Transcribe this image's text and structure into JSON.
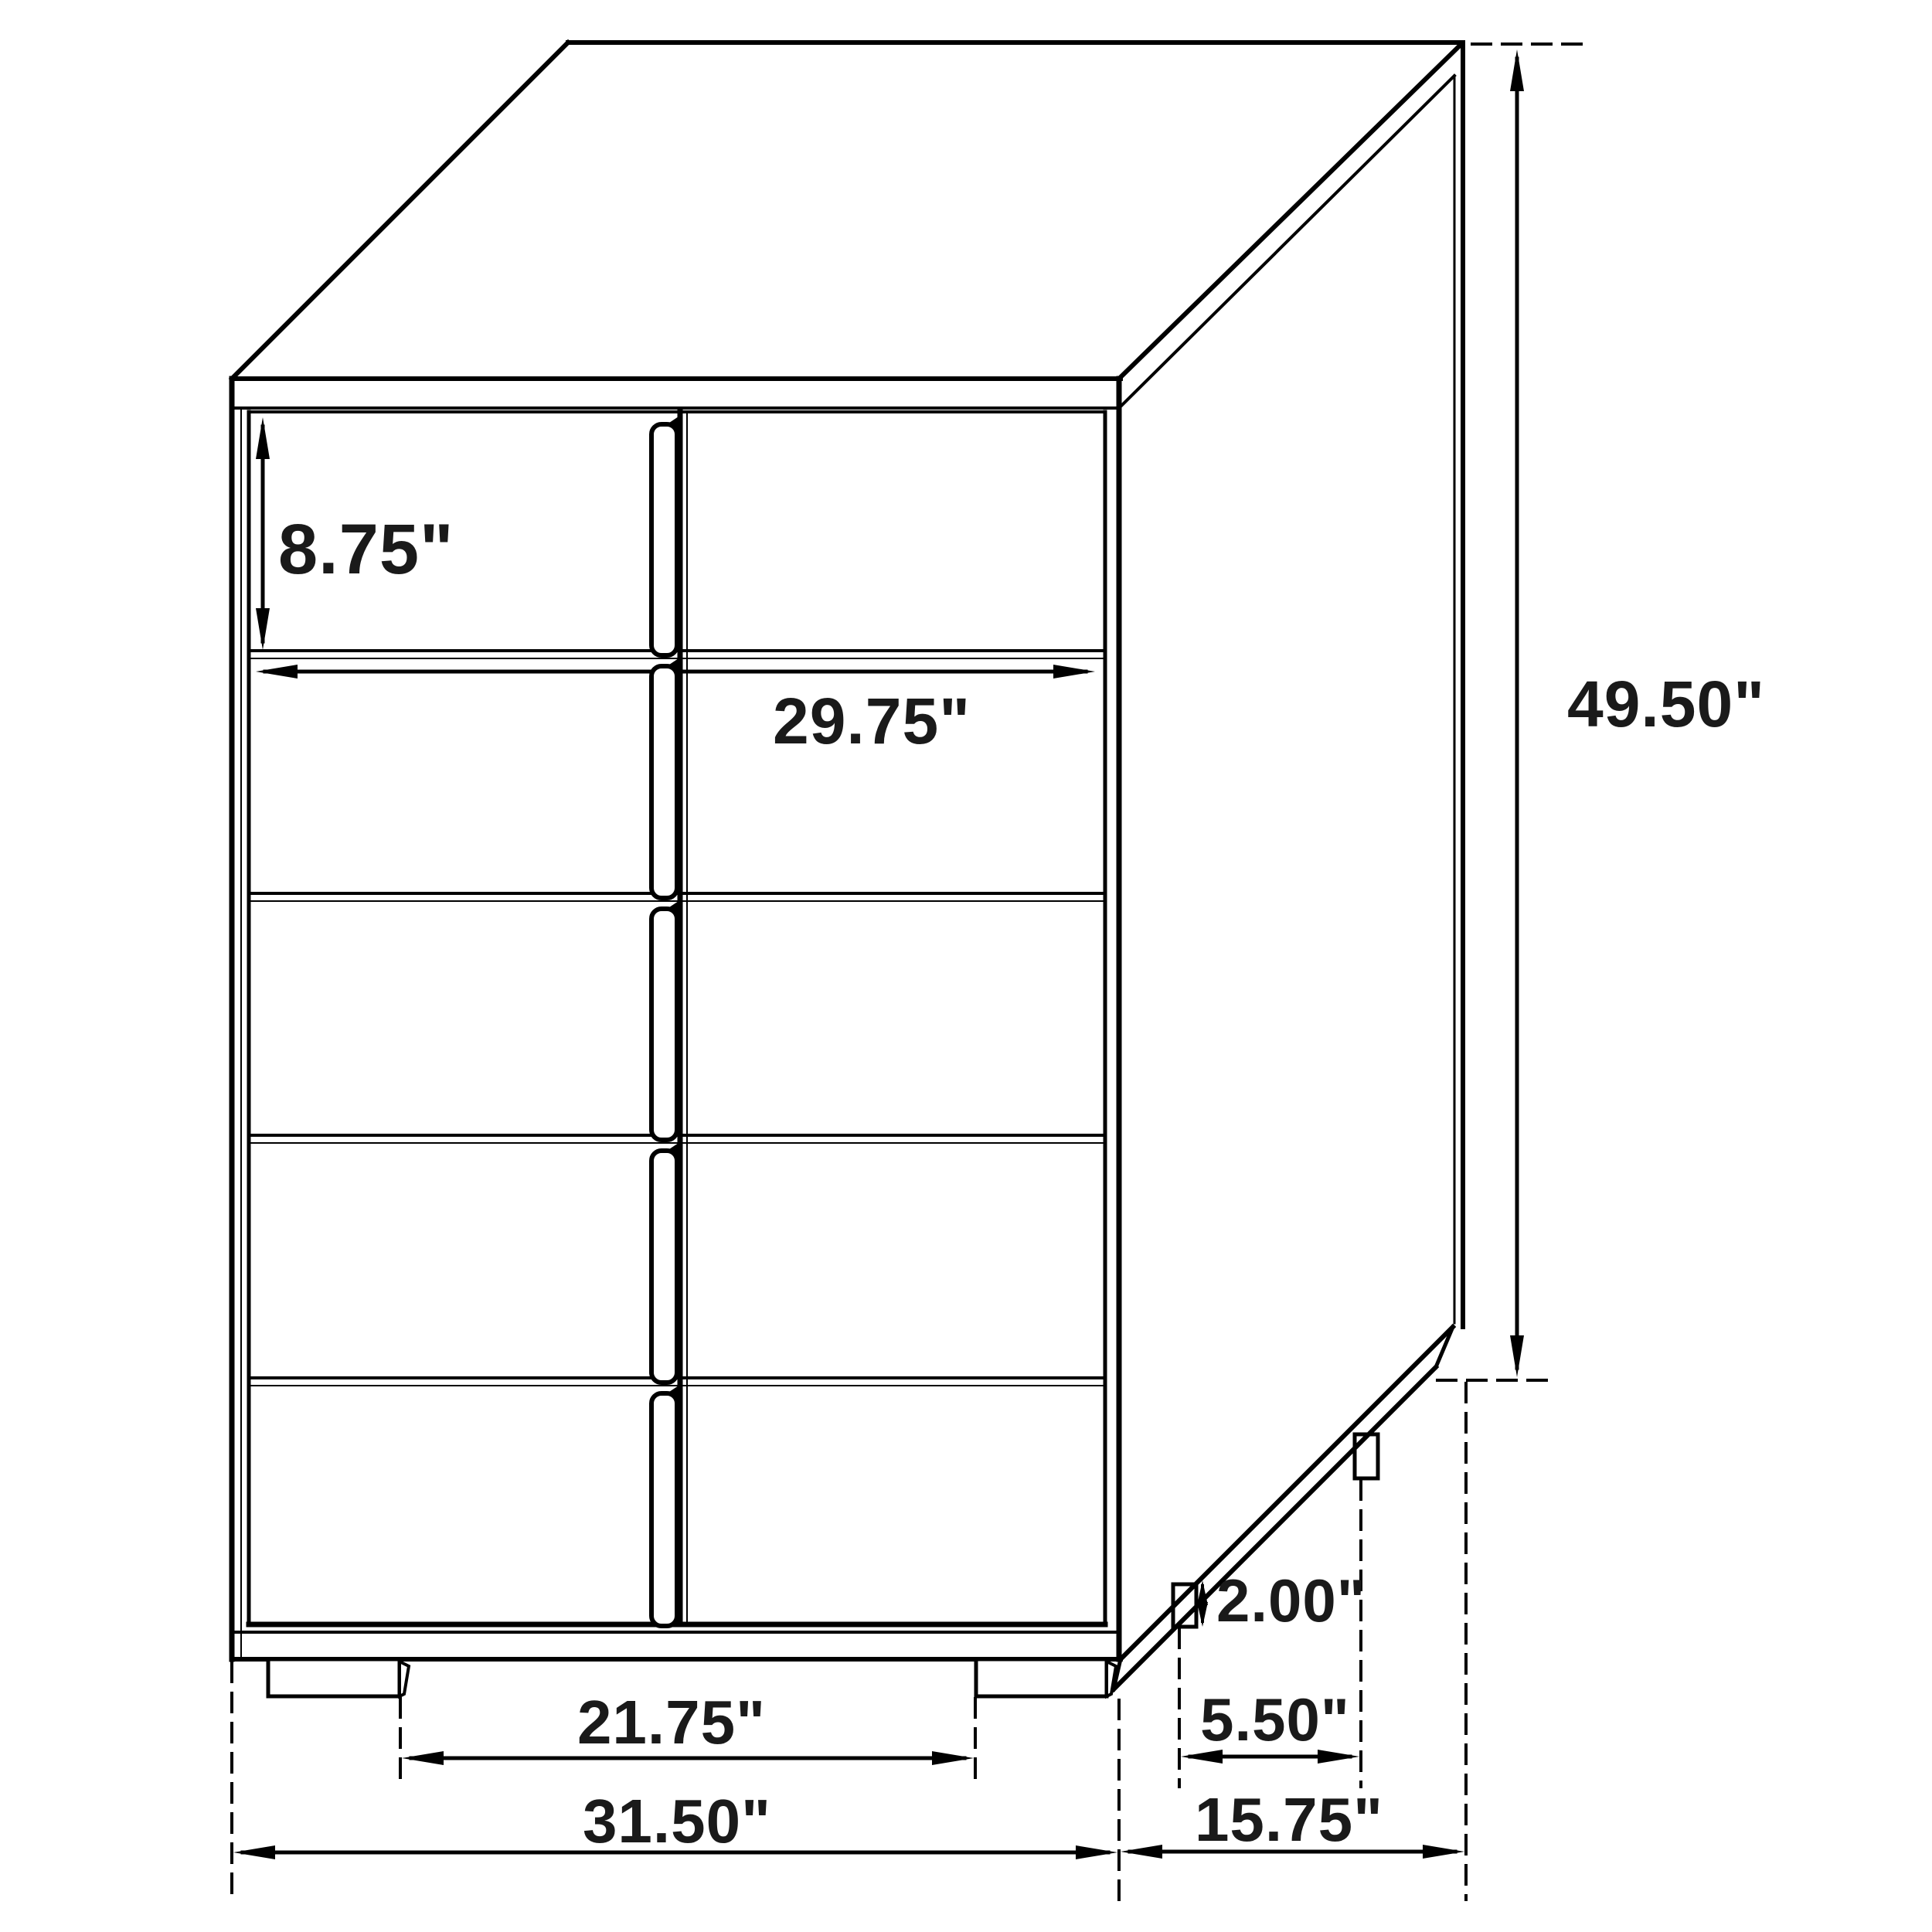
{
  "meta": {
    "type": "furniture dimensional line drawing",
    "item": "5-drawer chest (isometric view)",
    "line_color": "#000000",
    "background_color": "#ffffff",
    "text_color": "#1a1a1a"
  },
  "structure": {
    "drawer_count": 5,
    "handle_count": 5,
    "front_leg_count": 2,
    "side_leg_count": 2
  },
  "dimensions": {
    "top_drawer_height": {
      "label": "8.75\"",
      "value_in": 8.75,
      "measures": "top drawer front height"
    },
    "drawer_width": {
      "label": "29.75\"",
      "value_in": 29.75,
      "measures": "drawer front width"
    },
    "overall_height": {
      "label": "49.50\"",
      "value_in": 49.5,
      "measures": "overall height"
    },
    "leg_height": {
      "label": "2.00\"",
      "value_in": 2.0,
      "measures": "leg height"
    },
    "side_leg_spacing": {
      "label": "5.50\"",
      "value_in": 5.5,
      "measures": "spacing between side legs"
    },
    "front_leg_spacing": {
      "label": "21.75\"",
      "value_in": 21.75,
      "measures": "spacing between front legs"
    },
    "overall_width": {
      "label": "31.50\"",
      "value_in": 31.5,
      "measures": "overall width"
    },
    "overall_depth": {
      "label": "15.75\"",
      "value_in": 15.75,
      "measures": "overall depth"
    }
  }
}
